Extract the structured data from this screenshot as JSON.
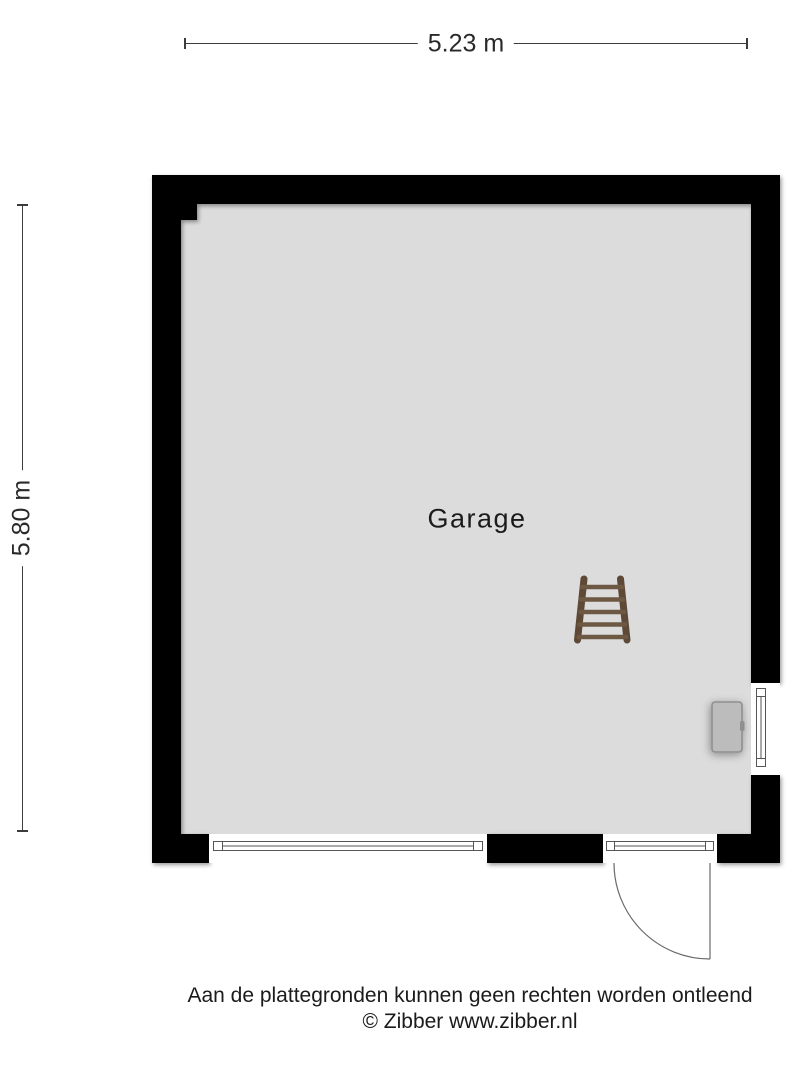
{
  "dimensions": {
    "width_label": "5.23 m",
    "height_label": "5.80 m"
  },
  "room": {
    "name": "Garage"
  },
  "fixtures": [
    {
      "name": "ladder-icon"
    },
    {
      "name": "boiler-icon"
    },
    {
      "name": "door-swing"
    },
    {
      "name": "window-bottom"
    },
    {
      "name": "window-right"
    },
    {
      "name": "door-transom-window"
    }
  ],
  "footer": {
    "disclaimer": "Aan de plattegronden kunnen geen rechten worden ontleend",
    "copyright": "© Zibber www.zibber.nl"
  },
  "colors": {
    "wall": "#000000",
    "floor": "#dcdcdc",
    "line": "#565656",
    "dim_line": "#3c3c3c",
    "text": "#1b1b1b",
    "ladder_rail": "#5e4936",
    "ladder_rung": "#6d5843",
    "boiler_fill": "#bcbcbc",
    "boiler_border": "#8f8f8f"
  }
}
